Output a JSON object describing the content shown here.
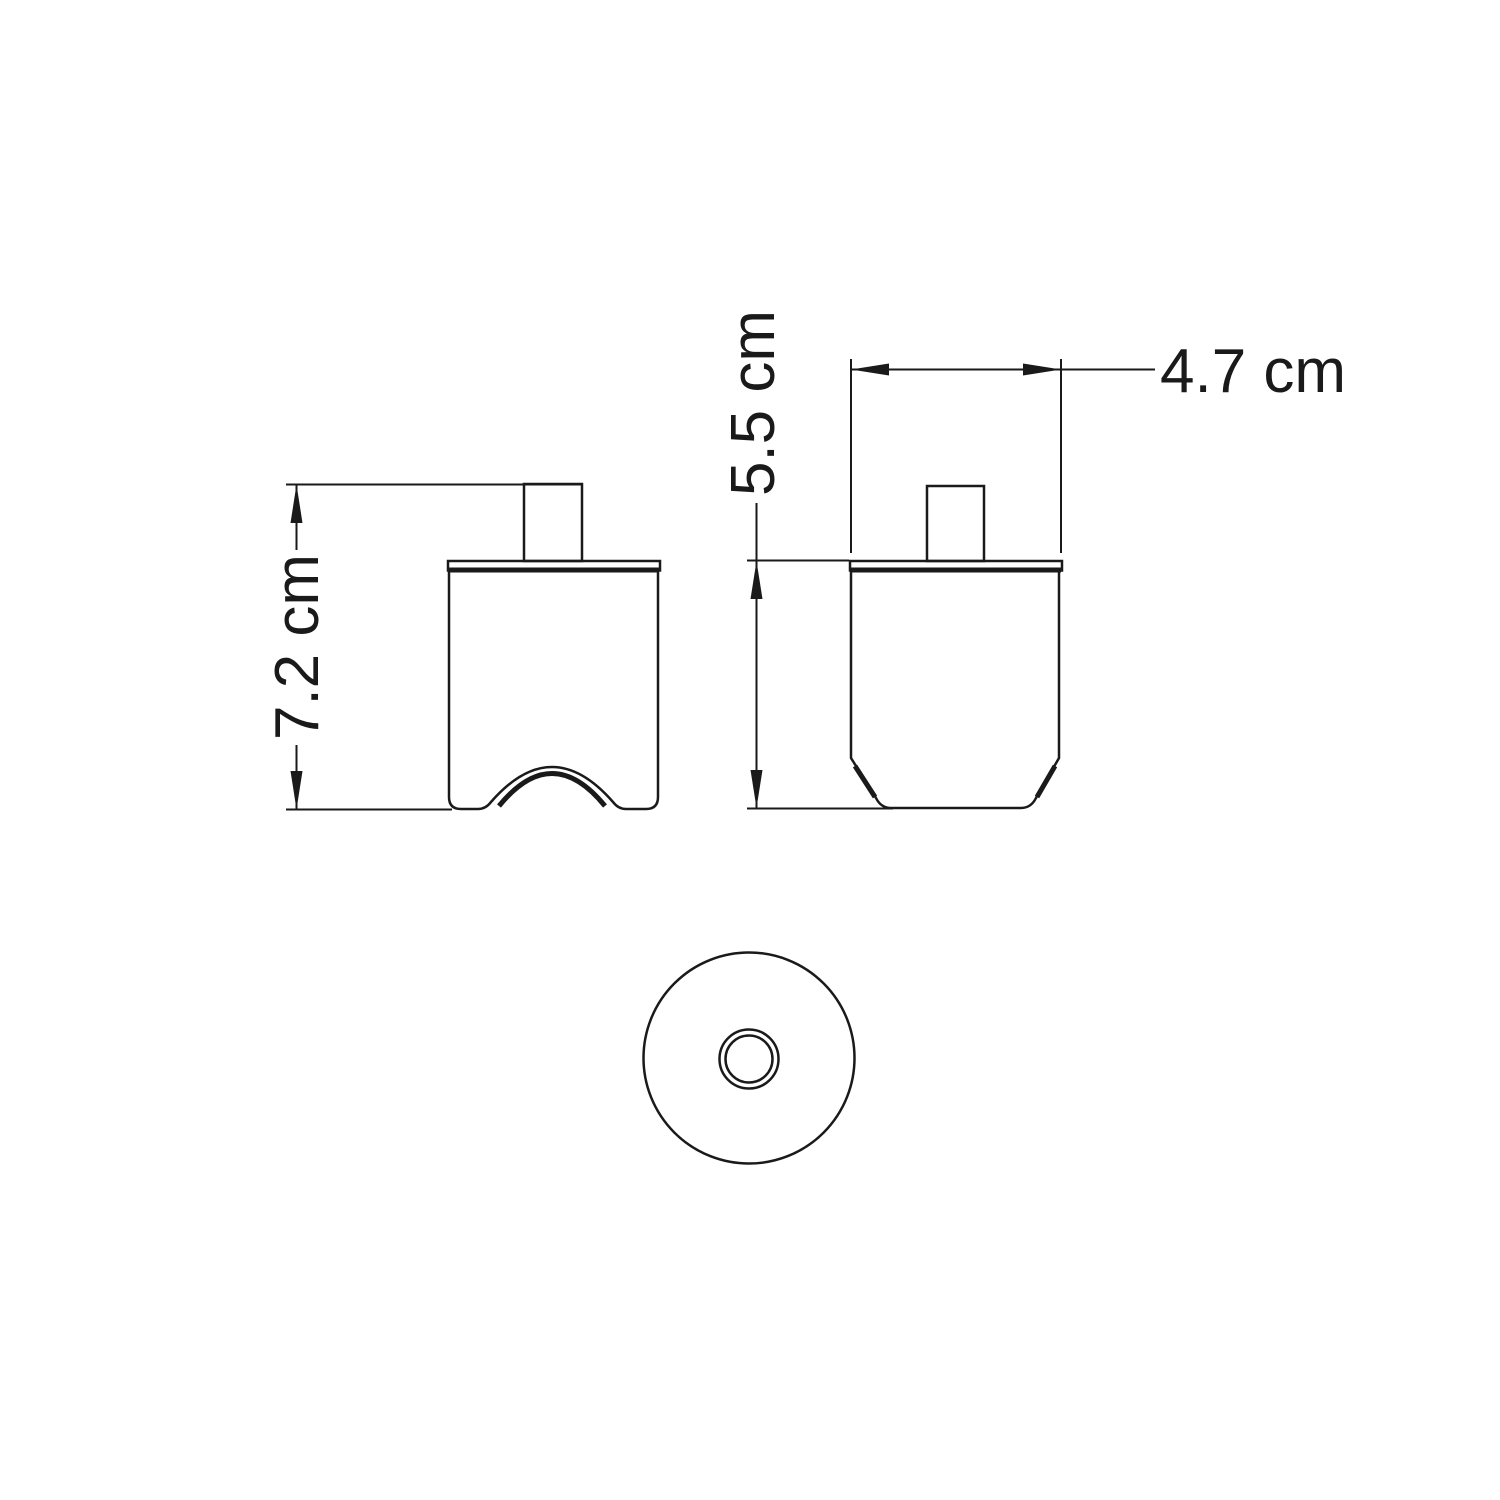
{
  "theme": {
    "background": "#ffffff",
    "line_color": "#1a1a1a"
  },
  "dimensions": {
    "front_height": {
      "label": "7.2 cm"
    },
    "side_height": {
      "label": "5.5 cm"
    },
    "width": {
      "label": "4.7 cm"
    }
  }
}
